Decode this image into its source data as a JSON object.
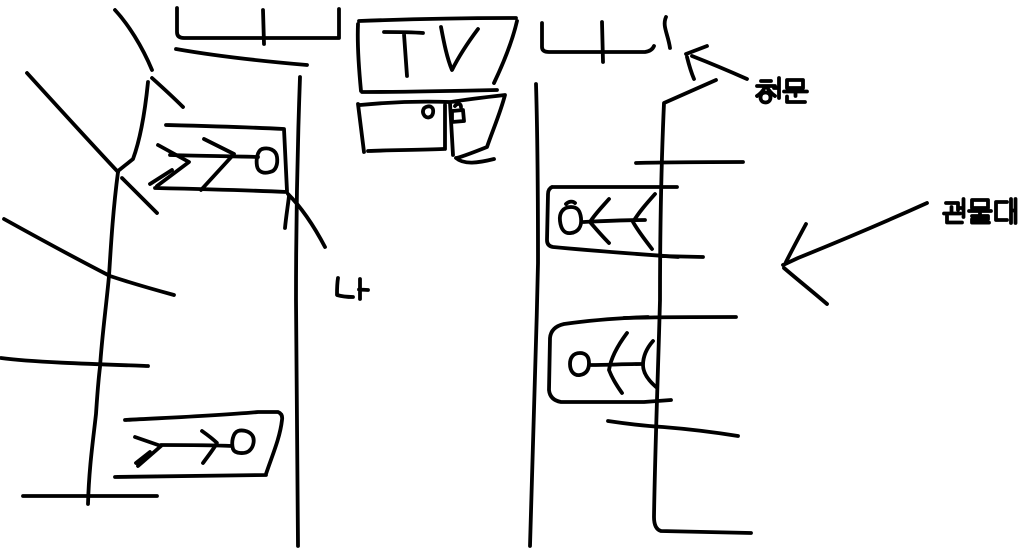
{
  "canvas": {
    "background_color": "#ffffff",
    "ink_color": "#000000"
  },
  "labels": {
    "tv": "TV",
    "window": "창문",
    "locker": "관물대",
    "me": "나"
  }
}
